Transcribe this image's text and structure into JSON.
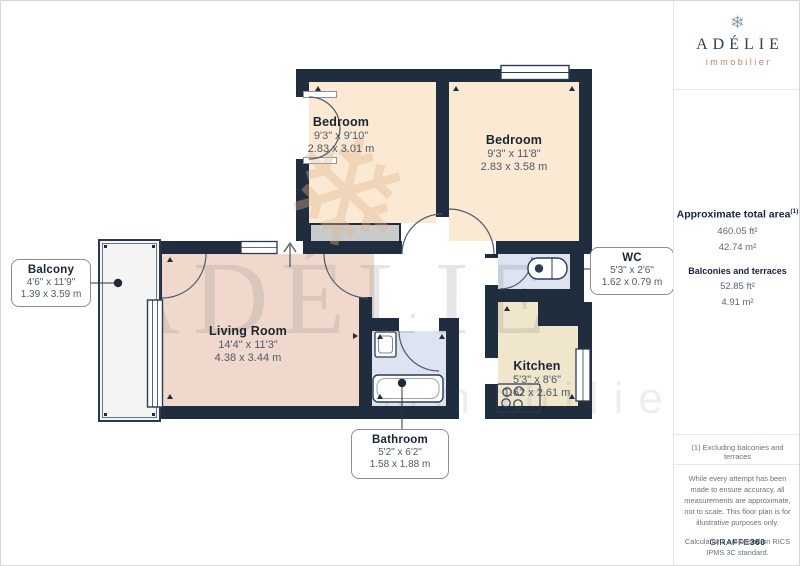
{
  "branding": {
    "icon": "❄",
    "name": "ADÉLIE",
    "tagline": "immobilier"
  },
  "sidebar": {
    "total_area_label": "Approximate total area",
    "total_area_sup": "(1)",
    "total_area_ft": "460.05 ft²",
    "total_area_m": "42.74 m²",
    "balconies_label": "Balconies and terraces",
    "balconies_ft": "52.85 ft²",
    "balconies_m": "4.91 m²",
    "footnote": "(1) Excluding balconies and terraces",
    "disclaimer1": "While every attempt has been made to ensure accuracy, all measurements are approximate, not to scale. This floor plan is for illustrative purposes only.",
    "disclaimer2": "Calculations are based on RICS IPMS 3C standard.",
    "credit_brand": "GIRAFFE",
    "credit_suffix": "360"
  },
  "floorplan": {
    "watermark_text": "ADÉLIE",
    "watermark_sub": "immobilier",
    "rooms": [
      {
        "id": "bedroom-1",
        "name": "Bedroom",
        "imperial": "9'3\" x 9'10\"",
        "metric": "2.83 x 3.01 m"
      },
      {
        "id": "bedroom-2",
        "name": "Bedroom",
        "imperial": "9'3\" x 11'8\"",
        "metric": "2.83 x 3.58 m"
      },
      {
        "id": "living-room",
        "name": "Living Room",
        "imperial": "14'4\" x 11'3\"",
        "metric": "4.38 x 3.44 m"
      },
      {
        "id": "kitchen",
        "name": "Kitchen",
        "imperial": "5'3\" x 8'6\"",
        "metric": "1.62 x 2.61 m"
      },
      {
        "id": "wc",
        "name": "WC",
        "imperial": "5'3\" x 2'6\"",
        "metric": "1.62 x 0.79 m"
      },
      {
        "id": "bathroom",
        "name": "Bathroom",
        "imperial": "5'2\" x 6'2\"",
        "metric": "1.58 x 1.88 m"
      },
      {
        "id": "balcony",
        "name": "Balcony",
        "imperial": "4'6\" x 11'9\"",
        "metric": "1.39 x 3.59 m"
      }
    ],
    "colors": {
      "wall": "#202d3e",
      "bedroom_fill": "#fce9d3",
      "living_fill": "#f0d9cc",
      "kitchen_fill": "#f0e6cb",
      "wet_room_fill": "#dde3f0",
      "closet_fill": "#c9caca",
      "accent_red": "#c27c70",
      "navy": "#2e3d52"
    }
  }
}
